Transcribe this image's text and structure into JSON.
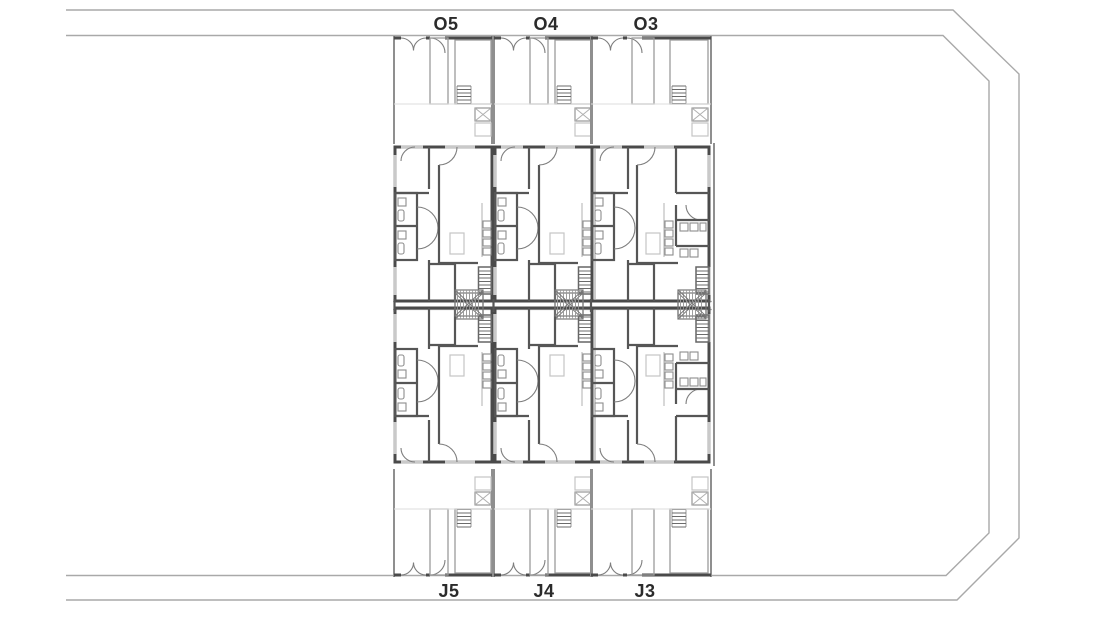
{
  "drawing": {
    "type": "architectural site / floor plan",
    "plot_labels": {
      "top": [
        "O5",
        "O4",
        "O3"
      ],
      "bottom": [
        "J5",
        "J4",
        "J3"
      ]
    }
  },
  "colors": {
    "background": "#ffffff",
    "wall_dark": "#4a4a4a",
    "wall_medium": "#8f8f8f",
    "furniture_light": "#c4c4c4",
    "site_boundary": "#a9a9a9",
    "label_text": "#2b2b2b"
  }
}
